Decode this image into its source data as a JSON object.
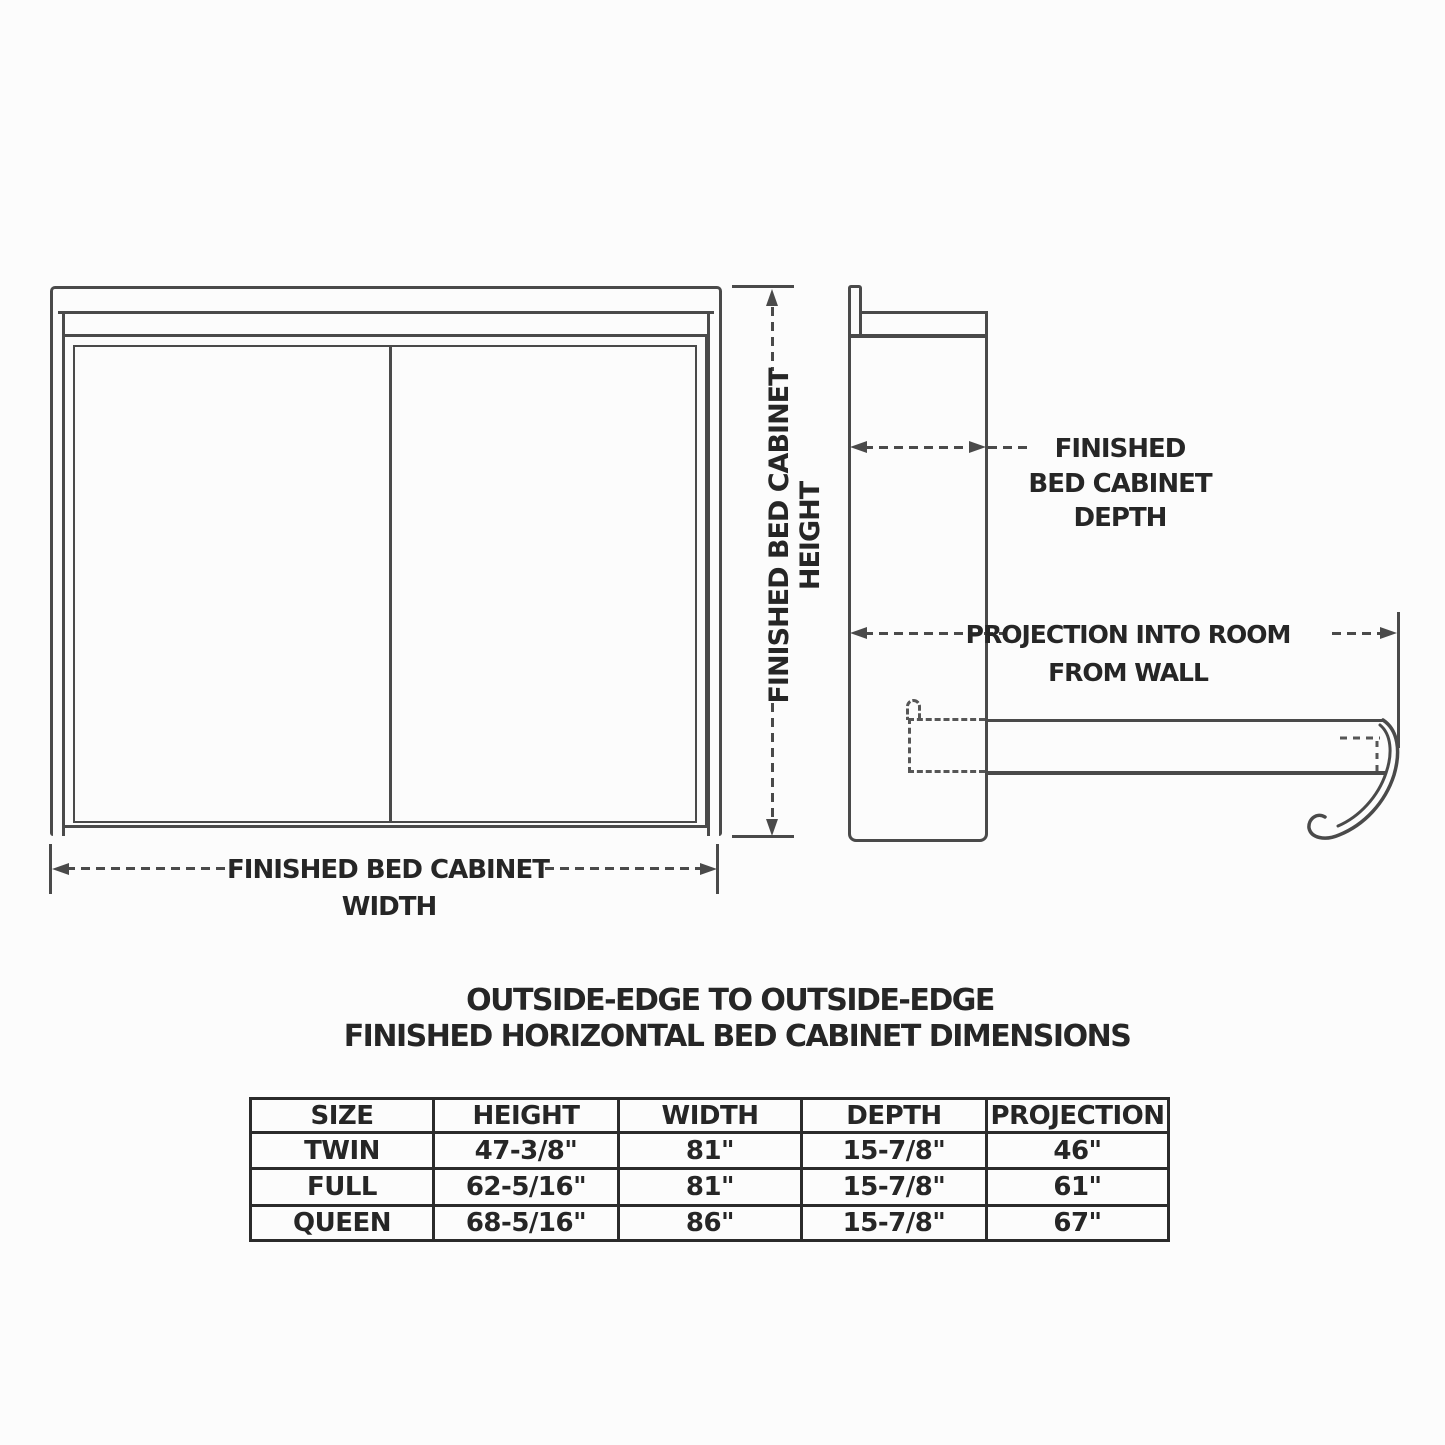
{
  "drawing": {
    "front_view": {
      "width_label": [
        "FINISHED BED CABINET",
        "WIDTH"
      ],
      "height_label": [
        "FINISHED BED CABINET",
        "HEIGHT"
      ]
    },
    "side_view": {
      "depth_label": [
        "FINISHED",
        "BED CABINET",
        "DEPTH"
      ],
      "projection_label": [
        "PROJECTION INTO ROOM",
        "FROM WALL"
      ]
    }
  },
  "table_section": {
    "title": [
      "OUTSIDE-EDGE TO OUTSIDE-EDGE",
      "FINISHED HORIZONTAL BED CABINET DIMENSIONS"
    ],
    "table": {
      "headers": [
        "SIZE",
        "HEIGHT",
        "WIDTH",
        "DEPTH",
        "PROJECTION"
      ],
      "rows": [
        {
          "size": "TWIN",
          "height": "47-3/8\"",
          "width": "81\"",
          "depth": "15-7/8\"",
          "projection": "46\""
        },
        {
          "size": "FULL",
          "height": "62-5/16\"",
          "width": "81\"",
          "depth": "15-7/8\"",
          "projection": "61\""
        },
        {
          "size": "QUEEN",
          "height": "68-5/16\"",
          "width": "86\"",
          "depth": "15-7/8\"",
          "projection": "67\""
        }
      ]
    }
  },
  "colors": {
    "line": "#4a4a4a",
    "text": "#262626",
    "table_border": "#2b2b2b",
    "background": "#fcfcfc"
  }
}
